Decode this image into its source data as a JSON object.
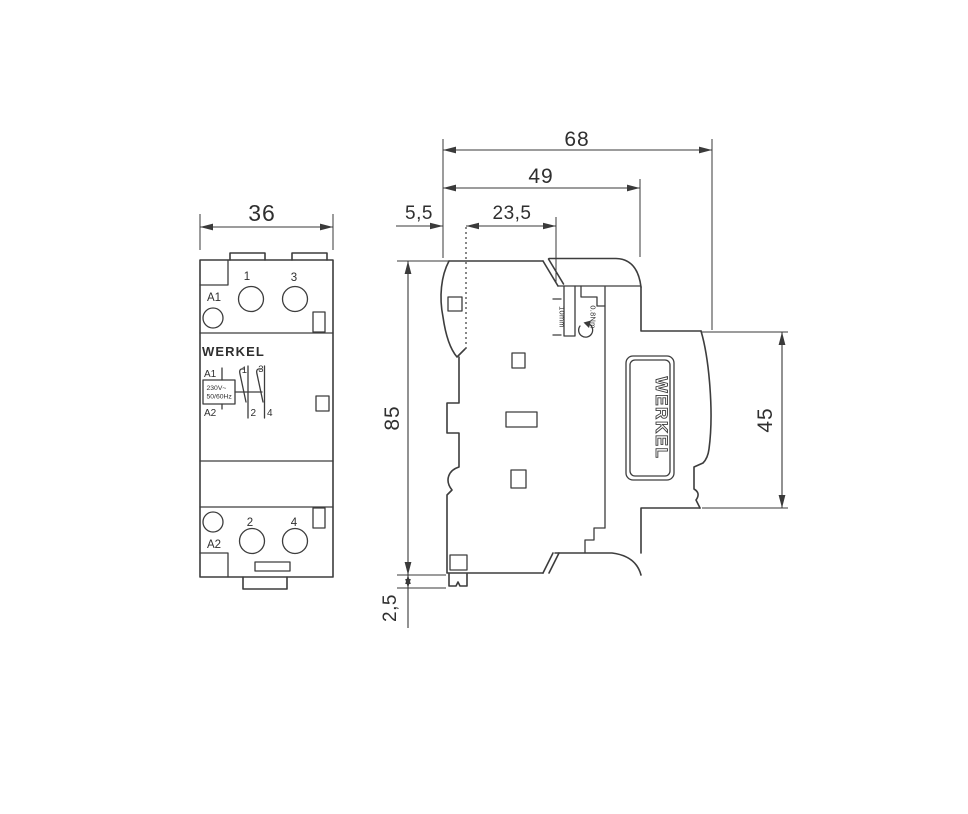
{
  "front": {
    "dim_width": "36",
    "brand": "WERKEL",
    "terminal_1": "1",
    "terminal_3": "3",
    "terminal_a1": "A1",
    "terminal_2": "2",
    "terminal_4": "4",
    "terminal_a2": "A2",
    "schematic": {
      "a1": "A1",
      "a2": "A2",
      "voltage": "230V~",
      "frequency": "50/60Hz",
      "pole1_top": "1",
      "pole1_bottom": "2",
      "pole2_top": "3",
      "pole2_bottom": "4"
    }
  },
  "side": {
    "brand": "WERKEL",
    "dim_total_depth": "68",
    "dim_body_depth": "49",
    "dim_din_offset": "5,5",
    "dim_front_depth": "23,5",
    "dim_height": "85",
    "dim_clip": "2,5",
    "dim_front_height": "45",
    "annotation_strip_length": "10mm",
    "annotation_torque": "0.8Nm"
  },
  "colors": {
    "line": "#3d3d3d",
    "brand_gold": "#8a6e4f",
    "background": "#ffffff"
  }
}
